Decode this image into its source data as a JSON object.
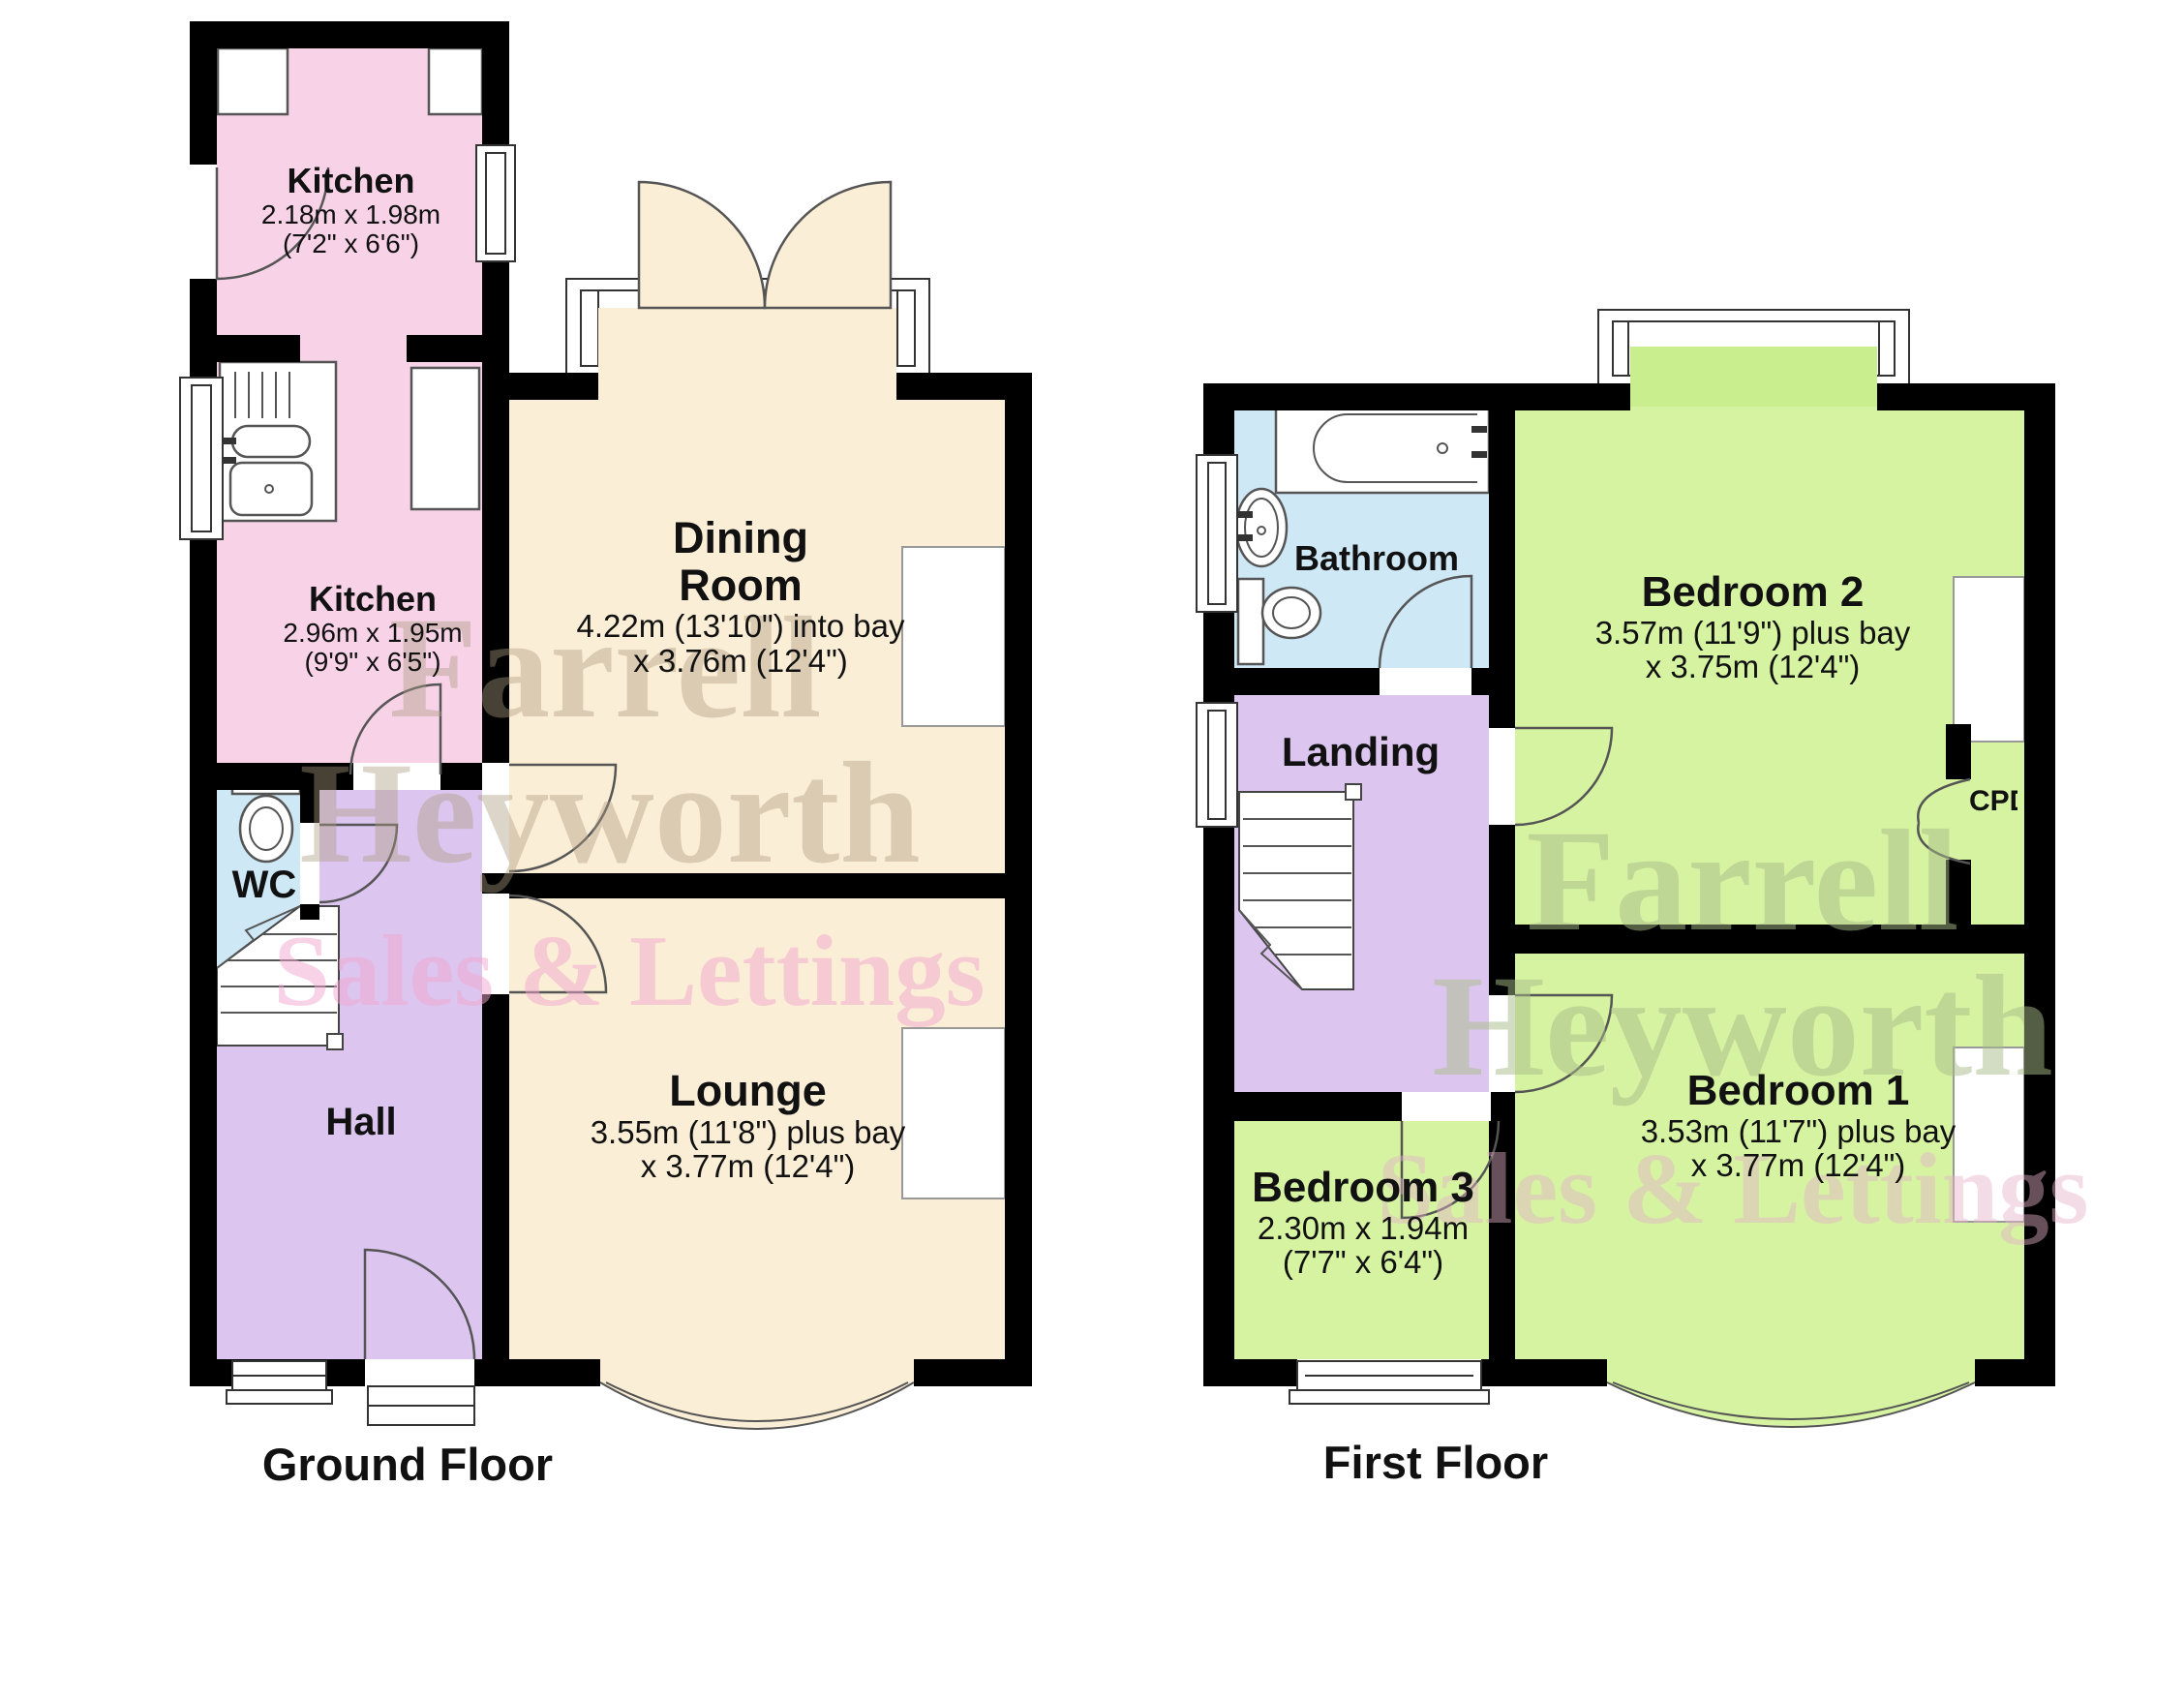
{
  "watermark": {
    "line1": "Farrell",
    "line2": "Heyworth",
    "line3": "Sales & Lettings"
  },
  "colors": {
    "wall": "#000000",
    "kitchen_pink": "#f8d3e8",
    "living_cream": "#fbeed6",
    "hall_purple": "#dcc6f0",
    "wet_blue": "#cfe8f6",
    "bedroom_green": "#d6f3a2",
    "bay_green": "#c9ee8e",
    "watermark_tan": "rgba(172,156,128,0.42)",
    "watermark_pink": "rgba(242,165,205,0.50)",
    "watermark_green": "rgba(168,188,135,0.50)",
    "watermark_pink2": "rgba(228,178,200,0.45)"
  },
  "ground_floor": {
    "label": "Ground Floor",
    "rooms": {
      "kitchen_rear": {
        "name": "Kitchen",
        "dim1": "2.18m x 1.98m",
        "dim2": "(7'2\" x 6'6\")"
      },
      "kitchen_main": {
        "name": "Kitchen",
        "dim1": "2.96m x 1.95m",
        "dim2": "(9'9\" x 6'5\")"
      },
      "dining": {
        "name_line1": "Dining",
        "name_line2": "Room",
        "dim1": "4.22m (13'10\") into bay",
        "dim2": "x 3.76m (12'4\")"
      },
      "lounge": {
        "name": "Lounge",
        "dim1": "3.55m (11'8\") plus bay",
        "dim2": "x 3.77m (12'4\")"
      },
      "wc": {
        "name": "WC"
      },
      "hall": {
        "name": "Hall"
      }
    }
  },
  "first_floor": {
    "label": "First Floor",
    "rooms": {
      "bathroom": {
        "name": "Bathroom"
      },
      "landing": {
        "name": "Landing"
      },
      "bedroom2": {
        "name": "Bedroom 2",
        "dim1": "3.57m (11'9\") plus bay",
        "dim2": "x 3.75m (12'4\")"
      },
      "bedroom1": {
        "name": "Bedroom 1",
        "dim1": "3.53m (11'7\") plus bay",
        "dim2": "x 3.77m (12'4\")"
      },
      "bedroom3": {
        "name": "Bedroom 3",
        "dim1": "2.30m x 1.94m",
        "dim2": "(7'7\" x 6'4\")"
      },
      "cupboard": {
        "name": "CPD"
      }
    }
  }
}
